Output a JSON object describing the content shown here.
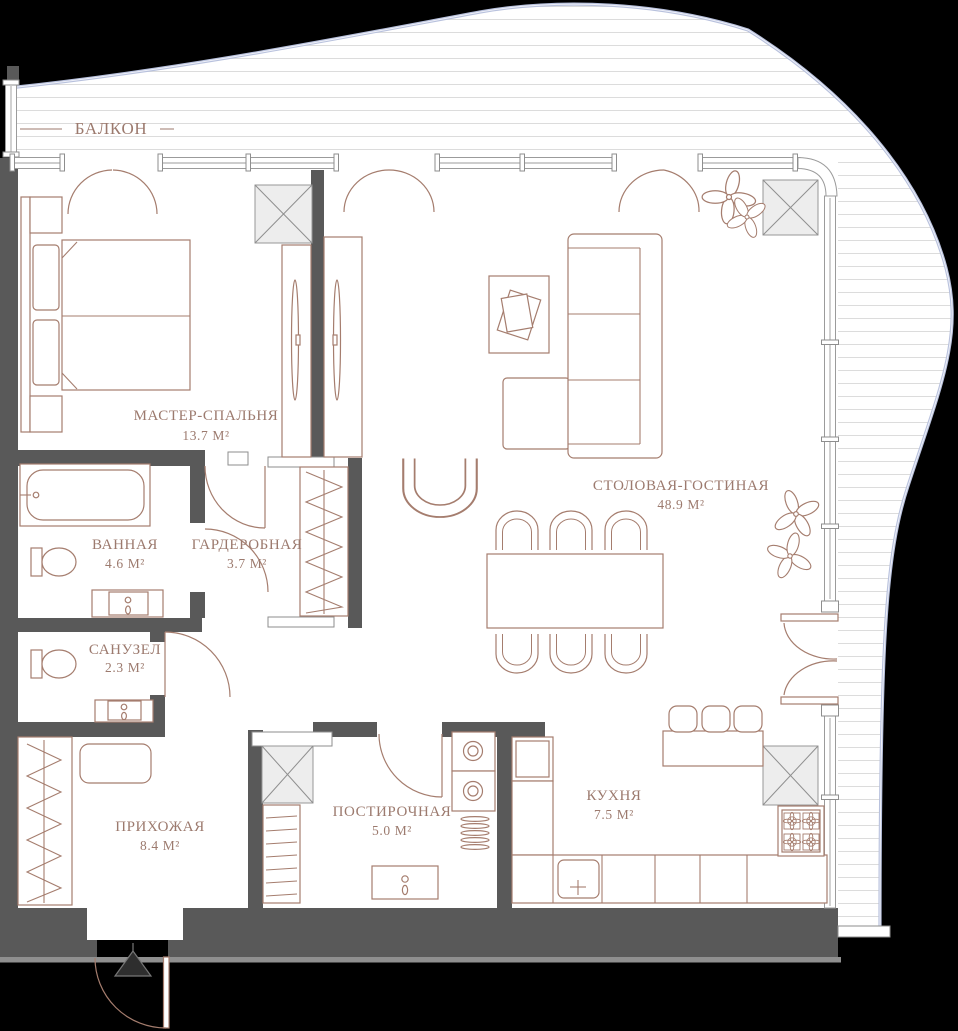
{
  "meta": {
    "type": "apartment-floor-plan",
    "language": "ru"
  },
  "colors": {
    "background": "#000000",
    "wall": "#595959",
    "furniture_line": "#a57d6e",
    "label_text": "#9c7a6e",
    "facade_glass": "#b8c1dd",
    "window_frame": "#9b9b9b",
    "shaft_fill": "#ededed",
    "balcony_hatch": "#dcdcdc"
  },
  "rooms": [
    {
      "id": "balcony",
      "name": "БАЛКОН",
      "area": ""
    },
    {
      "id": "master-bedroom",
      "name": "МАСТЕР-СПАЛЬНЯ",
      "area": "13.7 М²"
    },
    {
      "id": "bathroom",
      "name": "ВАННАЯ",
      "area": "4.6 М²"
    },
    {
      "id": "wardrobe",
      "name": "ГАРДЕРОБНАЯ",
      "area": "3.7 М²"
    },
    {
      "id": "wc",
      "name": "САНУЗЕЛ",
      "area": "2.3 М²"
    },
    {
      "id": "hallway",
      "name": "ПРИХОЖАЯ",
      "area": "8.4 М²"
    },
    {
      "id": "laundry",
      "name": "ПОСТИРОЧНАЯ",
      "area": "5.0 М²"
    },
    {
      "id": "kitchen",
      "name": "КУХНЯ",
      "area": "7.5 М²"
    },
    {
      "id": "living-dining",
      "name": "СТОЛОВАЯ-ГОСТИНАЯ",
      "area": "48.9 М²"
    }
  ]
}
